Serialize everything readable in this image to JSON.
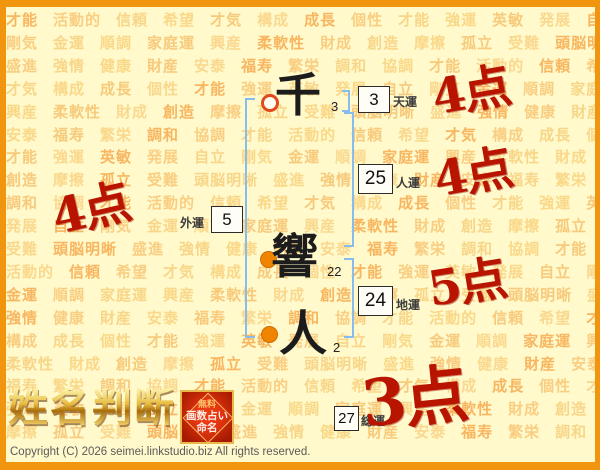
{
  "theme": {
    "bg": "#FFF9CB",
    "frame": "#F2950E",
    "bracket": "#87BCEC",
    "score": "#B81400",
    "watermark_colors": [
      "#F6A03E",
      "#F8B252",
      "#F5C05E",
      "#F9CE74",
      "#F3AB49",
      "#F7C366"
    ]
  },
  "watermark": {
    "words": [
      "才能",
      "活動的",
      "信頼",
      "希望",
      "才気",
      "構成",
      "成長",
      "個性",
      "才能",
      "強運",
      "英敏",
      "発展",
      "自立",
      "剛気",
      "金運",
      "順調",
      "家庭運",
      "興産",
      "柔軟性",
      "財成",
      "創造",
      "摩擦",
      "孤立",
      "受難",
      "頭脳明晰",
      "盛進",
      "強情",
      "健康",
      "財産",
      "安泰",
      "福寿",
      "繁栄",
      "調和",
      "協調"
    ]
  },
  "name_chart": {
    "characters": [
      {
        "char": "千",
        "strokes": "3",
        "marker": "open"
      },
      {
        "char": "響",
        "strokes": "22",
        "marker": "filled"
      },
      {
        "char": "人",
        "strokes": "2",
        "marker": "filled"
      }
    ],
    "results": [
      {
        "key": "tenun",
        "label": "天運",
        "value": "3",
        "score": "4点"
      },
      {
        "key": "jinun",
        "label": "人運",
        "value": "25",
        "score": "4点"
      },
      {
        "key": "gaiun",
        "label": "外運",
        "value": "5",
        "score": "4点"
      },
      {
        "key": "chiun",
        "label": "地運",
        "value": "24",
        "score": "5点"
      },
      {
        "key": "souun",
        "label": "総運",
        "value": "27",
        "score": "3点"
      }
    ]
  },
  "logo": {
    "title": "姓名判断",
    "badge_lines": [
      "無料",
      "画数占い",
      "命名"
    ]
  },
  "footer": {
    "copyright": "Copyright (C) 2026 seimei.linkstudio.biz All rights reserved."
  }
}
